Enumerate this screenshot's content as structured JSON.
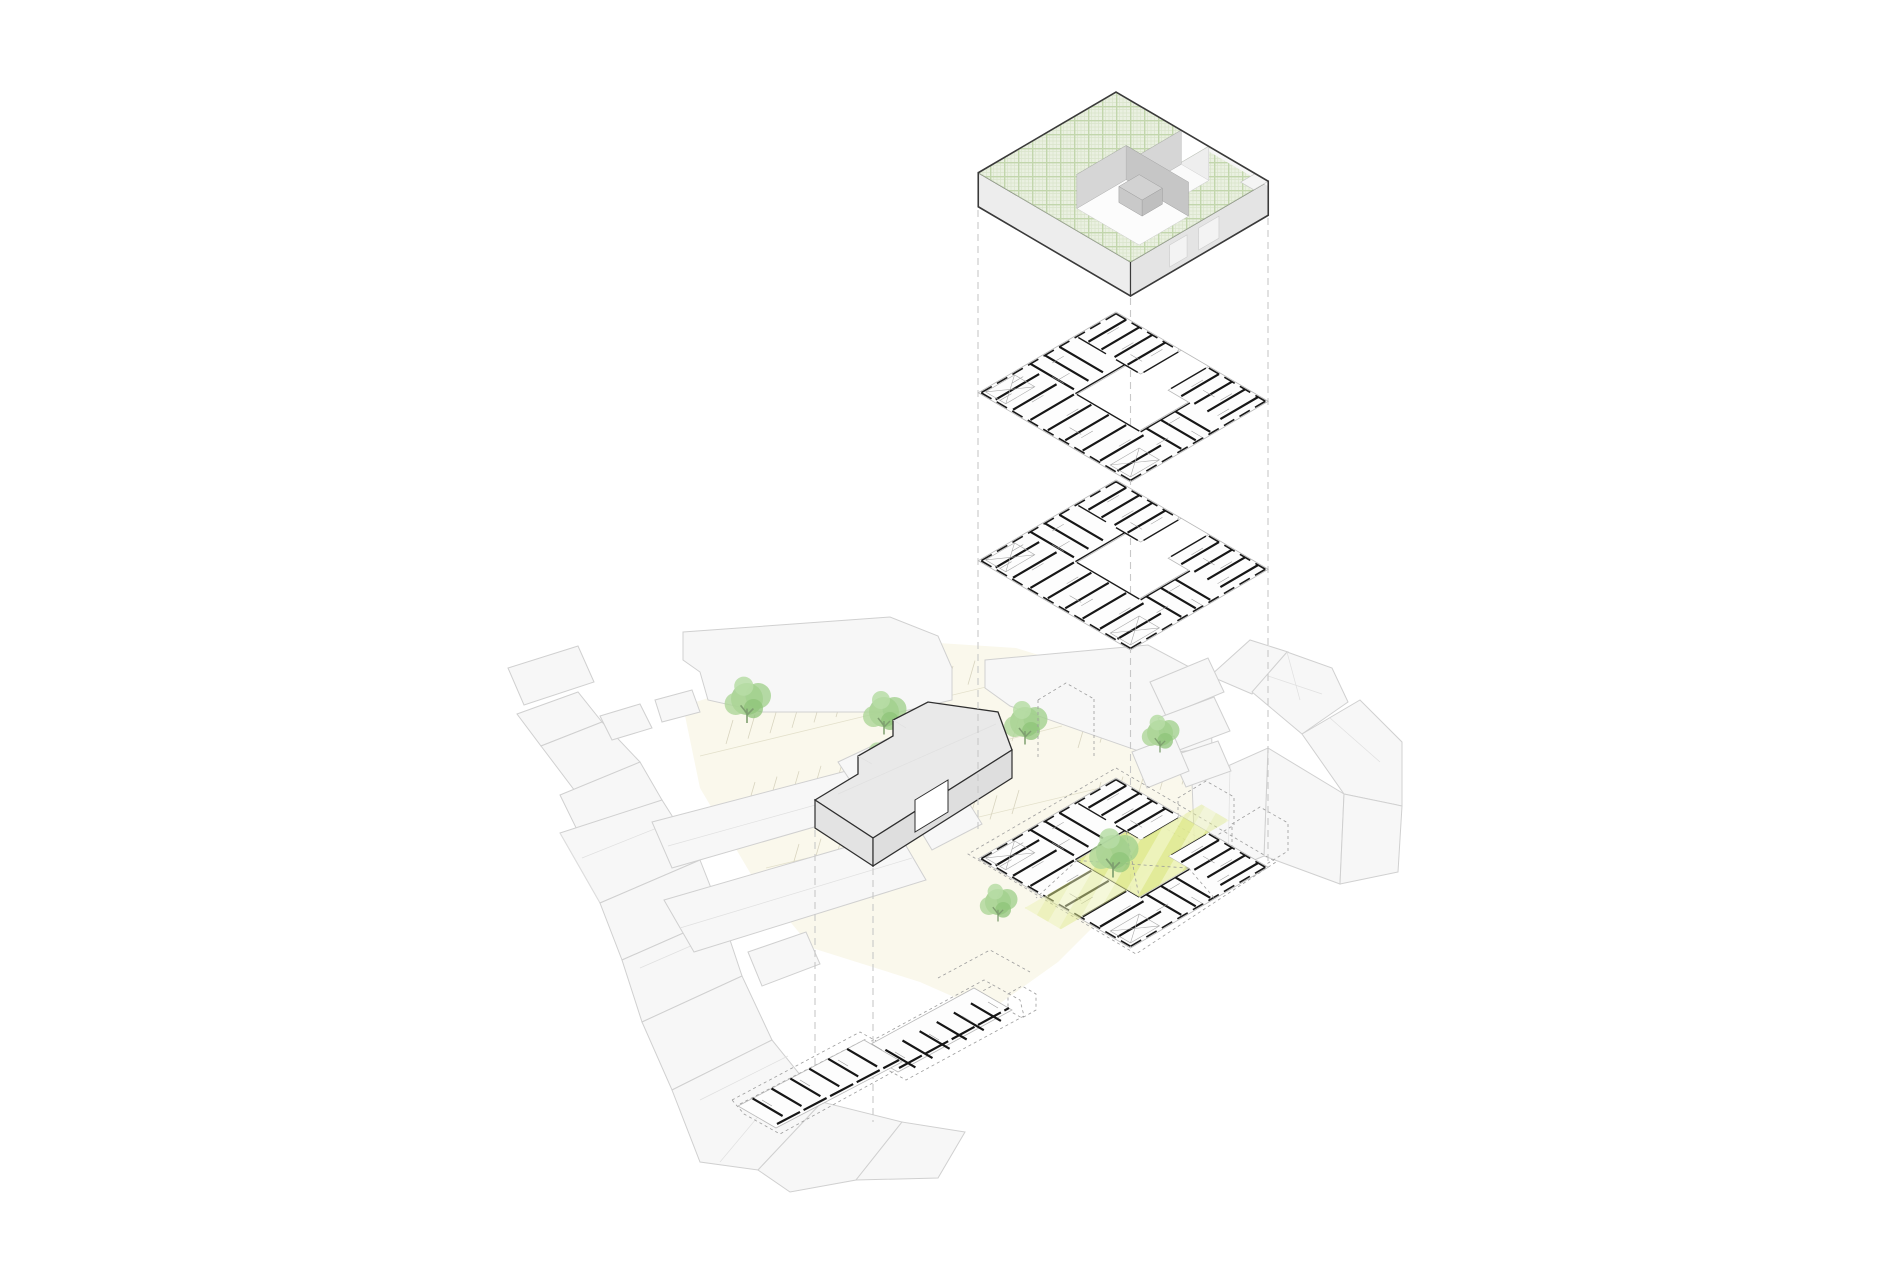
{
  "scene": {
    "background": "#ffffff",
    "levels": [
      "roof-volume",
      "upper-floor-plan",
      "lower-floor-plan",
      "ground-floor-site-plan"
    ],
    "site": {
      "tree_count": 7,
      "highlighted_area": "courtyard"
    }
  },
  "colors": {
    "outline_dark": "#3a3a3a",
    "wall_black": "#161616",
    "bar_outline": "#2f2f2f",
    "volume_fill": "#ececec",
    "roof_green_bg": "#eaf0e1",
    "roof_green_grid": "#c2d6ac",
    "courtyard_wall": "#c6c6c6",
    "context_fill": "#f7f7f7",
    "context_stroke": "#d0d0d0",
    "parking_cream": "#faf8ec",
    "parking_lines": "#d8d4bf",
    "tree_green": "#9ccb86",
    "highlight_yellow": "#dfe98e",
    "highlight_yellow_light": "#ecf2b6",
    "dash_gray": "#c8c8c8",
    "plan_slab": "#fdfdfd",
    "plan_thin": "#9a9a9a"
  }
}
